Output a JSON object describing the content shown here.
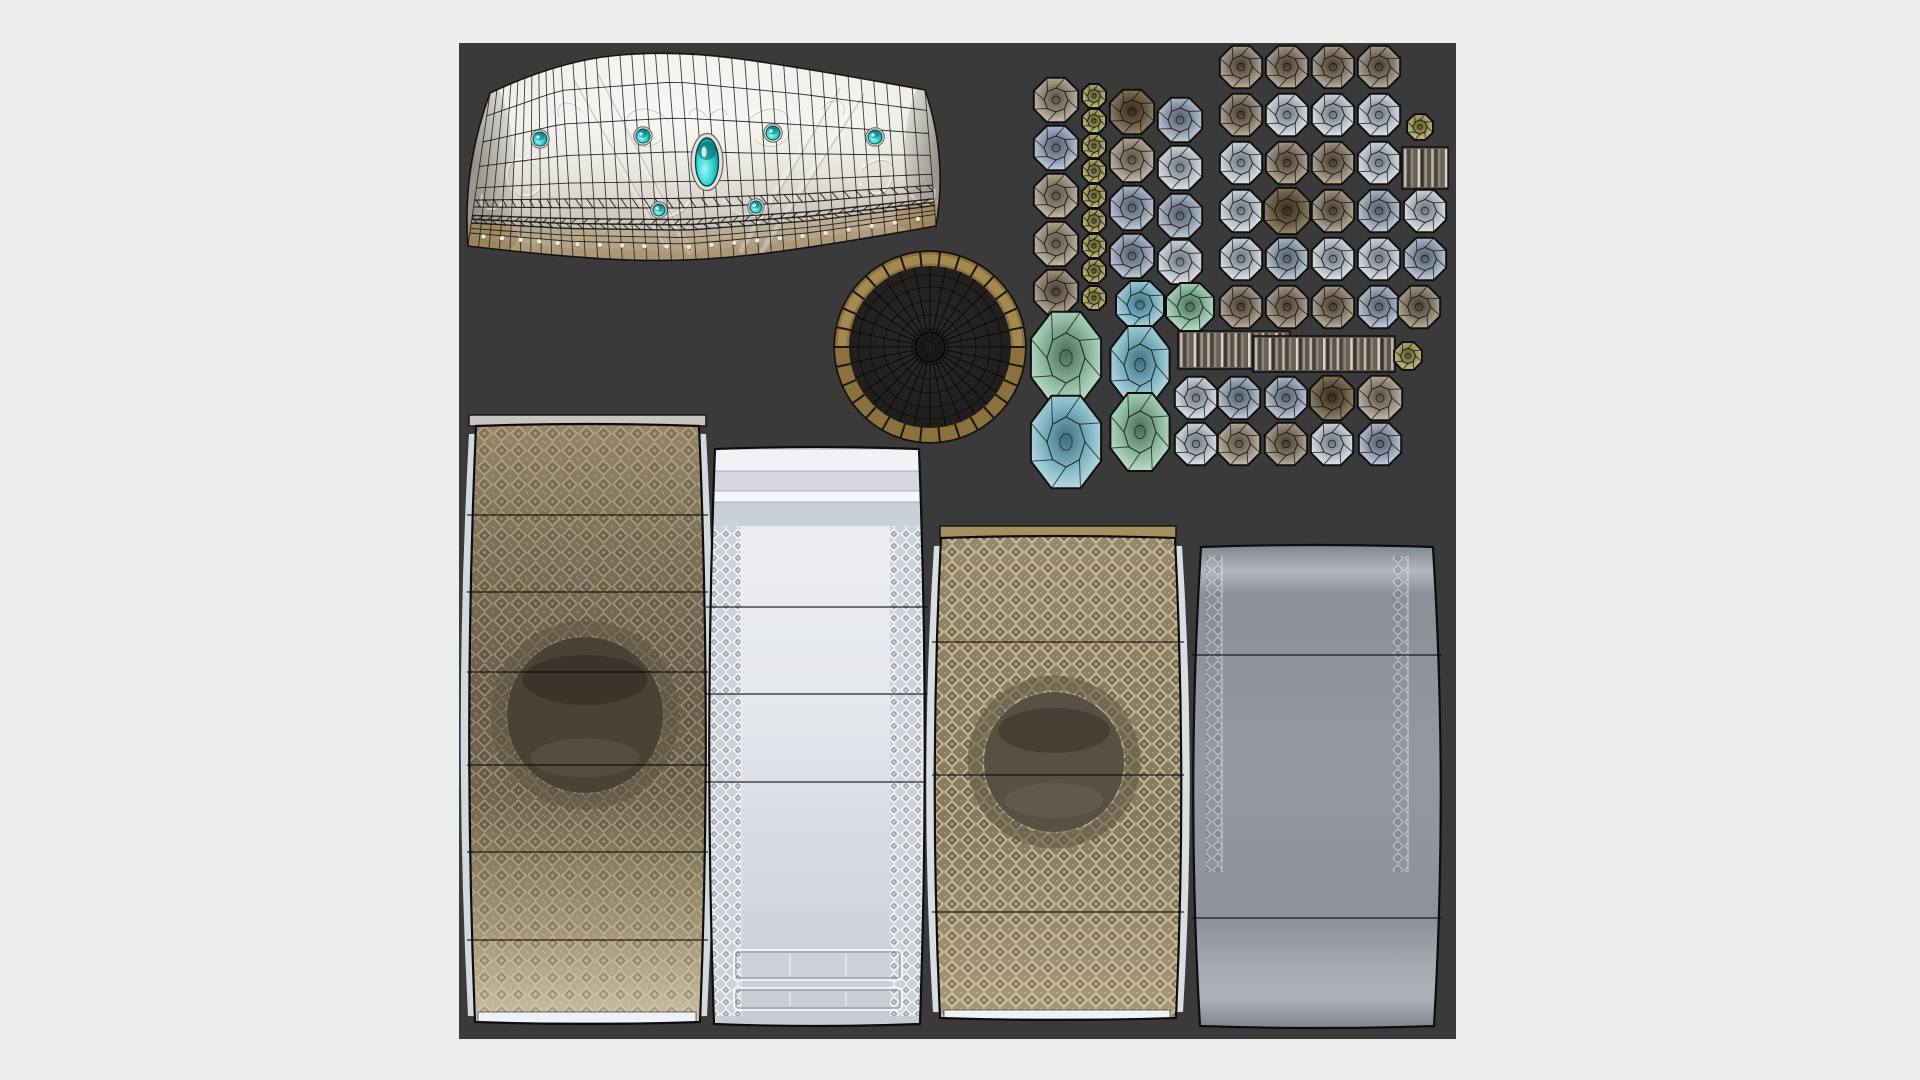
{
  "scene": {
    "background_color": "#ededed",
    "canvas": {
      "x": 459,
      "y": 43,
      "width": 997,
      "height": 996,
      "color": "#3a3a3a"
    }
  },
  "palette": {
    "wire": "rgba(16,16,16,0.8)",
    "octagon": {
      "T": [
        "#46392b",
        "#8d8070",
        "#cfc7b8"
      ],
      "S": [
        "#6b7177",
        "#b9bfc7",
        "#f2f4f6"
      ],
      "B": [
        "#4e5a68",
        "#94a2b2",
        "#dde4ec"
      ],
      "Y": [
        "#5c5530",
        "#a59d62",
        "#e3dca6"
      ],
      "D": [
        "#35291a",
        "#6f6049",
        "#a89a82"
      ],
      "G": [
        "#4b6b55",
        "#8fbca0",
        "#cfeadb"
      ],
      "A": [
        "#3f6e7e",
        "#84b9c6",
        "#cfe8ee"
      ],
      "C": [
        "#5a4e3e",
        "#9c9080",
        "#dcd5c8"
      ]
    },
    "stripes": [
      "#bdb8ae",
      "#4a443a",
      "#8d8576",
      "#6b6457",
      "#d8d4ca",
      "#3a352c",
      "#9c9486",
      "#5a5348"
    ],
    "gem_teal": [
      "#9ff5ee",
      "#2fd8d4",
      "#0a7d86"
    ]
  },
  "band": {
    "top": [
      [
        490,
        93
      ],
      [
        558,
        61
      ],
      [
        673,
        50
      ],
      [
        800,
        67
      ],
      [
        925,
        90
      ]
    ],
    "bottom": [
      [
        468,
        246
      ],
      [
        570,
        258
      ],
      [
        690,
        262
      ],
      [
        812,
        248
      ],
      [
        936,
        226
      ]
    ],
    "left_bulge": [
      462,
      170
    ],
    "right_bulge": [
      948,
      158
    ],
    "gradient": [
      [
        0,
        "#efece6"
      ],
      [
        0.35,
        "#e9e5dd"
      ],
      [
        0.6,
        "#d6d0c5"
      ],
      [
        0.8,
        "#c2bbae"
      ],
      [
        1,
        "#b5ab99"
      ]
    ],
    "verticals": 40,
    "horizontals": [
      [
        0.15,
        0.9
      ],
      [
        0.32,
        0.9
      ],
      [
        0.48,
        0.9
      ],
      [
        0.62,
        0.9
      ],
      [
        0.7,
        1.1
      ],
      [
        0.745,
        1.1
      ],
      [
        0.8,
        1.4
      ],
      [
        0.825,
        1.5
      ],
      [
        0.85,
        1.4
      ],
      [
        0.885,
        0.9
      ],
      [
        0.915,
        0.9
      ]
    ],
    "hatch": [
      [
        0.7,
        0.745,
        1
      ],
      [
        0.8,
        0.825,
        -1
      ],
      [
        0.825,
        0.85,
        1
      ]
    ],
    "rivet_fraction": 0.93,
    "gem_big": {
      "x": 707,
      "y": 162,
      "rx": 11.5,
      "ry": 24
    },
    "gems_small": [
      [
        540,
        139,
        7
      ],
      [
        643,
        136,
        7
      ],
      [
        773,
        133,
        7
      ],
      [
        875,
        137,
        7
      ],
      [
        659,
        210,
        6
      ],
      [
        756,
        207,
        6
      ]
    ],
    "ornaments": [
      "M668,120 C650,100 620,105 625,130 C628,146 650,150 660,138",
      "M746,120 C764,100 794,105 789,130 C786,146 764,150 754,138",
      "M690,200 C680,220 650,222 648,205",
      "M724,200 C734,220 764,222 766,205",
      "M540,170 C520,150 500,160 510,185 C516,200 535,198 540,186",
      "M860,170 C880,150 900,160 890,182 C884,198 866,196 860,184",
      "M580,110 C570,96 552,100 558,116",
      "M820,108 C830,94 848,98 842,114",
      "M505,200 C495,215 478,210 482,196",
      "M912,196 C922,210 938,204 934,190",
      "M707,118 C700,106 690,104 688,114",
      "M707,118 C714,106 724,104 726,114"
    ],
    "diagonals": [
      [
        572,
        78,
        668,
        248
      ],
      [
        596,
        72,
        690,
        252
      ],
      [
        838,
        86,
        742,
        250
      ],
      [
        862,
        92,
        762,
        252
      ]
    ]
  },
  "disc": {
    "cx": 930,
    "cy": 347,
    "outer_r": 95,
    "ring_inner_r": 81,
    "ring_color": "#8a713d",
    "ring_dark": "#5e4d28",
    "interior_color": "#232220",
    "spokes": 32,
    "ring_ticks": 30,
    "rings": [
      18,
      32,
      46,
      60,
      72
    ],
    "hub_r": 15
  },
  "gem_field": {
    "octagons": [
      [
        1056,
        100,
        24,
        "C"
      ],
      [
        1056,
        148,
        24,
        "B"
      ],
      [
        1056,
        196,
        24,
        "C"
      ],
      [
        1056,
        244,
        24,
        "C"
      ],
      [
        1056,
        292,
        24,
        "T"
      ],
      [
        1094,
        96,
        13,
        "Y"
      ],
      [
        1094,
        121,
        13,
        "Y"
      ],
      [
        1094,
        146,
        13,
        "Y"
      ],
      [
        1094,
        171,
        13,
        "Y"
      ],
      [
        1094,
        196,
        13,
        "Y"
      ],
      [
        1094,
        221,
        13,
        "Y"
      ],
      [
        1094,
        246,
        13,
        "Y"
      ],
      [
        1094,
        271,
        13,
        "Y"
      ],
      [
        1094,
        298,
        13,
        "Y"
      ],
      [
        1132,
        112,
        24,
        "D"
      ],
      [
        1132,
        160,
        24,
        "C"
      ],
      [
        1132,
        208,
        24,
        "B"
      ],
      [
        1132,
        256,
        24,
        "B"
      ],
      [
        1180,
        120,
        24,
        "B"
      ],
      [
        1180,
        168,
        24,
        "S"
      ],
      [
        1180,
        216,
        24,
        "B"
      ],
      [
        1180,
        262,
        24,
        "S"
      ],
      [
        1241,
        67,
        23,
        "T"
      ],
      [
        1287,
        67,
        23,
        "T"
      ],
      [
        1333,
        67,
        23,
        "T"
      ],
      [
        1379,
        67,
        23,
        "T"
      ],
      [
        1241,
        115,
        23,
        "T"
      ],
      [
        1287,
        115,
        23,
        "S"
      ],
      [
        1333,
        115,
        23,
        "S"
      ],
      [
        1379,
        115,
        23,
        "S"
      ],
      [
        1420,
        127,
        14,
        "Y"
      ],
      [
        1241,
        163,
        23,
        "S"
      ],
      [
        1287,
        163,
        23,
        "T"
      ],
      [
        1333,
        163,
        23,
        "T"
      ],
      [
        1379,
        163,
        23,
        "S"
      ],
      [
        1241,
        211,
        23,
        "S"
      ],
      [
        1287,
        211,
        25,
        "D"
      ],
      [
        1333,
        211,
        23,
        "T"
      ],
      [
        1379,
        211,
        23,
        "B"
      ],
      [
        1425,
        211,
        23,
        "S"
      ],
      [
        1241,
        259,
        23,
        "S"
      ],
      [
        1287,
        259,
        23,
        "B"
      ],
      [
        1333,
        259,
        23,
        "S"
      ],
      [
        1379,
        259,
        23,
        "S"
      ],
      [
        1425,
        259,
        23,
        "B"
      ],
      [
        1241,
        307,
        23,
        "T"
      ],
      [
        1287,
        307,
        23,
        "T"
      ],
      [
        1333,
        307,
        23,
        "T"
      ],
      [
        1379,
        307,
        23,
        "B"
      ],
      [
        1419,
        307,
        23,
        "T"
      ],
      [
        1196,
        398,
        23,
        "S"
      ],
      [
        1239,
        398,
        23,
        "B"
      ],
      [
        1286,
        398,
        23,
        "B"
      ],
      [
        1332,
        398,
        24,
        "D"
      ],
      [
        1380,
        398,
        24,
        "C"
      ],
      [
        1196,
        444,
        23,
        "S"
      ],
      [
        1239,
        444,
        23,
        "C"
      ],
      [
        1286,
        444,
        23,
        "T"
      ],
      [
        1332,
        444,
        23,
        "S"
      ],
      [
        1380,
        444,
        23,
        "B"
      ],
      [
        1066,
        358,
        38,
        "G",
        1
      ],
      [
        1066,
        442,
        38,
        "A",
        1
      ],
      [
        1140,
        305,
        26,
        "A"
      ],
      [
        1190,
        307,
        26,
        "G"
      ],
      [
        1140,
        365,
        32,
        "A",
        1
      ],
      [
        1140,
        432,
        32,
        "G",
        1
      ],
      [
        1408,
        356,
        15,
        "Y"
      ]
    ],
    "bars": [
      [
        1402,
        147,
        46,
        42
      ],
      [
        1178,
        331,
        112,
        38
      ],
      [
        1253,
        336,
        142,
        36
      ]
    ]
  },
  "panels": [
    {
      "name": "bronze-cuff-outer",
      "x1": 473,
      "y1": 426,
      "x2": 702,
      "y2": 1022,
      "bulge": 10,
      "edge": "#d3dade",
      "grad": [
        [
          0,
          "#958669"
        ],
        [
          0.2,
          "#7d7059"
        ],
        [
          0.45,
          "#6a5f4c"
        ],
        [
          0.62,
          "#70654f"
        ],
        [
          0.85,
          "#a4967a"
        ],
        [
          1,
          "#c9bda2"
        ]
      ],
      "pattern": "patB1",
      "pattern_opacity": 0.8,
      "cap": {
        "x": 469,
        "y": 415,
        "w": 237,
        "h": 11,
        "color": "#c6c5c1"
      },
      "bottom_strip": {
        "x": 478,
        "y": 1012,
        "w": 218,
        "h": 11,
        "color": "#eef2f5"
      },
      "hole": {
        "x": 585,
        "y": 715,
        "r": 78,
        "color": "#4b4234"
      },
      "lines": [
        515,
        592,
        672,
        765,
        852,
        940
      ]
    },
    {
      "name": "silver-cuff-outer",
      "x1": 712,
      "y1": 449,
      "x2": 922,
      "y2": 1024,
      "bulge": 8,
      "grad": [
        [
          0,
          "#eef0f3"
        ],
        [
          0.45,
          "#e4e7ec"
        ],
        [
          1,
          "#c7ccd4"
        ]
      ],
      "bands": [
        {
          "y": 449,
          "h": 22,
          "c": "#f0f2f5"
        },
        {
          "y": 471,
          "h": 20,
          "c": "#d5d9df"
        },
        {
          "y": 491,
          "h": 11,
          "c": "#f4f6f8"
        },
        {
          "y": 502,
          "h": 24,
          "c": "#cad0d8"
        }
      ],
      "trims": [
        {
          "x": 709,
          "w": 32
        },
        {
          "x": 890,
          "w": 32
        }
      ],
      "trim_y": [
        526,
        1016
      ],
      "trim_base": "#cdd2d9",
      "trim_pattern": "patBraid",
      "molding": [
        {
          "x": 734,
          "y": 950,
          "w": 168,
          "h": 30
        },
        {
          "x": 734,
          "y": 988,
          "w": 168,
          "h": 22
        }
      ],
      "lines": [
        607,
        694,
        782
      ]
    },
    {
      "name": "khaki-cuff-inner",
      "x1": 938,
      "y1": 538,
      "x2": 1178,
      "y2": 1018,
      "bulge": 9,
      "edge": "#d8dee2",
      "grad": [
        [
          0,
          "#98896a"
        ],
        [
          0.3,
          "#8d7f63"
        ],
        [
          0.6,
          "#887a5f"
        ],
        [
          1,
          "#a89a78"
        ]
      ],
      "pattern": "patB3",
      "pattern_opacity": 0.9,
      "cap": {
        "x": 940,
        "y": 526,
        "w": 236,
        "h": 12,
        "color": "#a5915f"
      },
      "bottom_strip": {
        "x": 944,
        "y": 1010,
        "w": 226,
        "h": 9,
        "color": "#eef2f4"
      },
      "hole": {
        "x": 1054,
        "y": 762,
        "r": 70,
        "color": "#585142"
      },
      "lines": [
        642,
        775,
        912
      ]
    },
    {
      "name": "steel-cuff-inner",
      "x1": 1198,
      "y1": 547,
      "x2": 1436,
      "y2": 1026,
      "bulge": 12,
      "grad": [
        [
          0,
          "#84888f"
        ],
        [
          0.05,
          "#b4b7bf"
        ],
        [
          0.1,
          "#8b8f98"
        ],
        [
          0.45,
          "#9498a2"
        ],
        [
          0.78,
          "#8d919b"
        ],
        [
          0.87,
          "#a4a8b0"
        ],
        [
          0.94,
          "#aeb2ba"
        ],
        [
          1,
          "#84878f"
        ]
      ],
      "trims": [
        {
          "x": 1206,
          "w": 16
        },
        {
          "x": 1392,
          "w": 16
        }
      ],
      "trim_y": [
        556,
        872
      ],
      "trim_pattern": "patBraid4",
      "lines": [
        655,
        918
      ]
    }
  ]
}
